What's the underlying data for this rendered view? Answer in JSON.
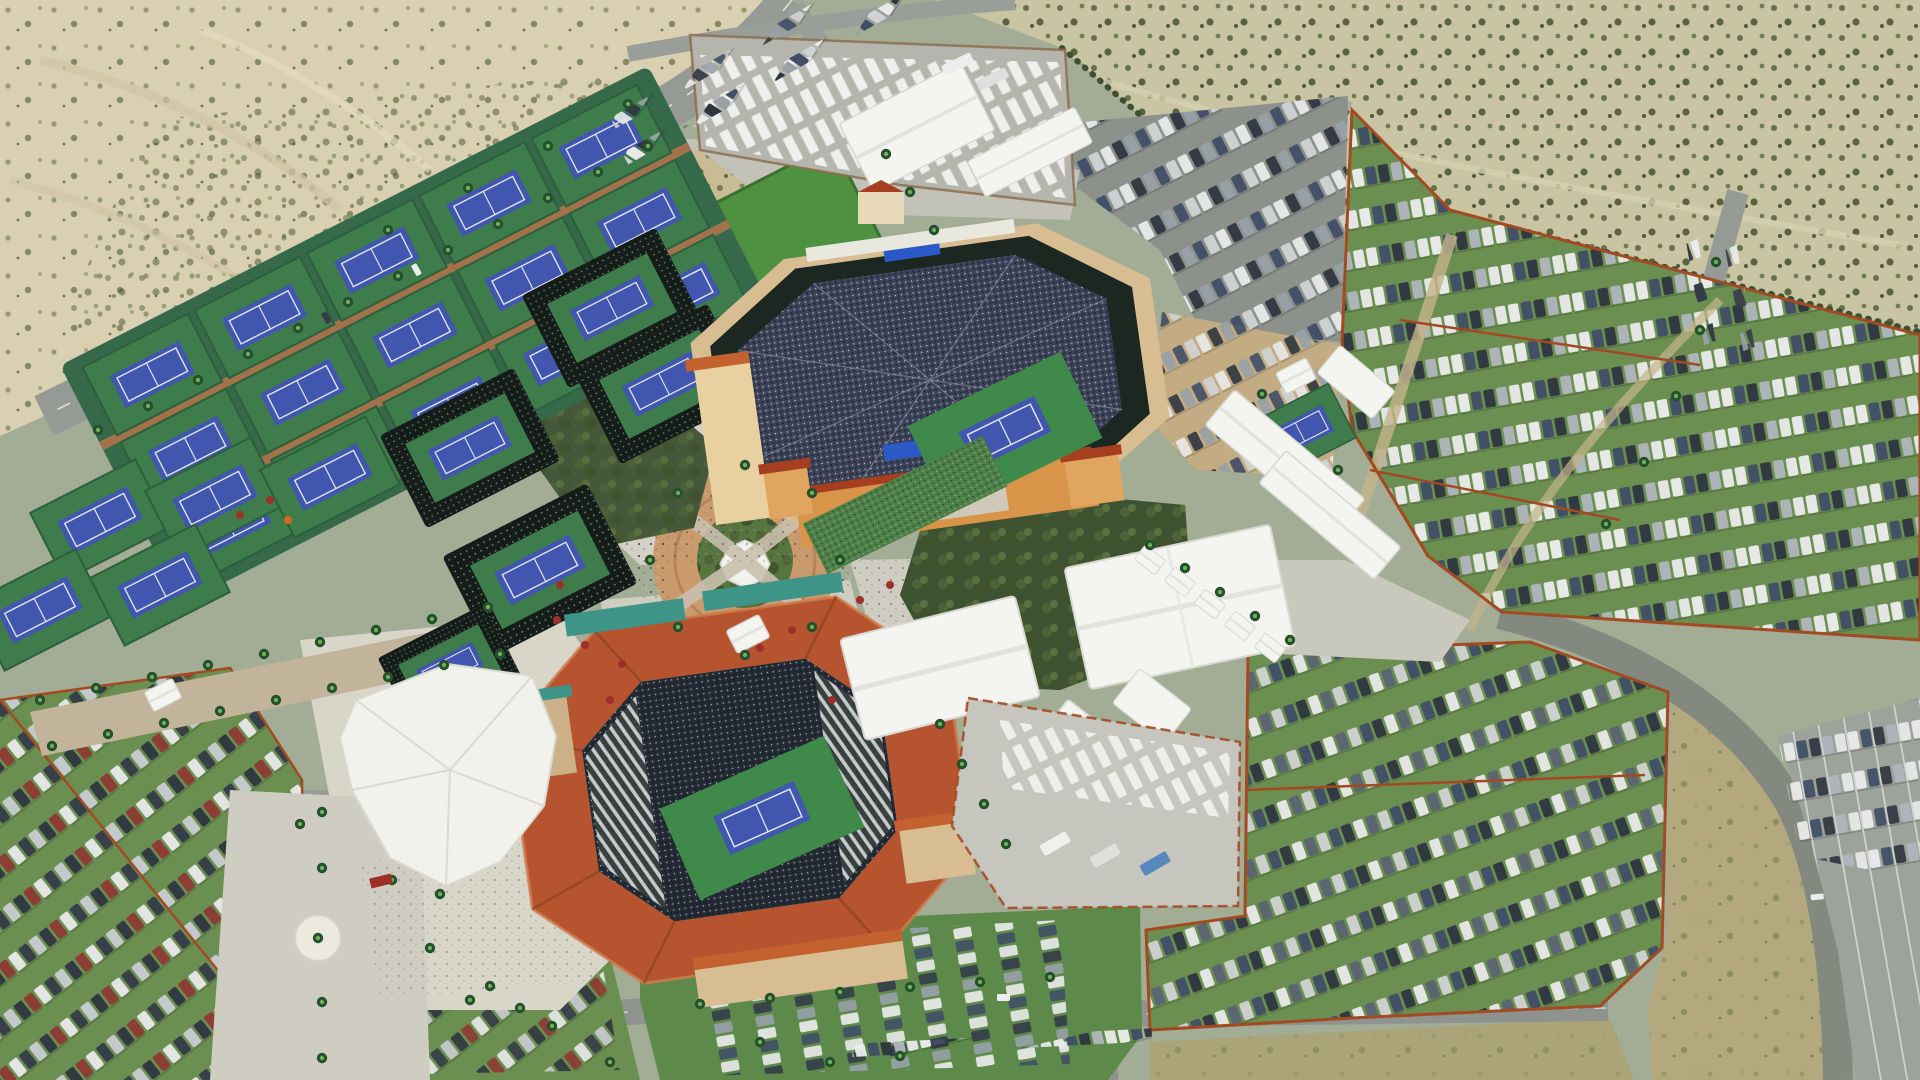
{
  "image": {
    "kind": "aerial-photograph",
    "subject": "large outdoor tennis tournament venue in a desert valley, oblique aerial view",
    "visible_text": "none",
    "width": 1920,
    "height": 1080
  },
  "scene": {
    "landmarks": [
      {
        "name": "desert-northwest",
        "desc": "bare sand with sparse scrub, upper left"
      },
      {
        "name": "desert-northeast",
        "desc": "scrub-covered desert field, upper right"
      },
      {
        "name": "perimeter-boulevard",
        "desc": "diagonal divided road with palms and curbside parked cars, upper left"
      },
      {
        "name": "practice-court-grid",
        "desc": "rows of blue tennis courts on green pads, northwest quadrant"
      },
      {
        "name": "sunken-show-courts",
        "desc": "five small match courts with dark bleachers and crowds"
      },
      {
        "name": "stadium-1",
        "desc": "large octagonal stadium, tan/orange buildings, packed crowd, blue court"
      },
      {
        "name": "stadium-2",
        "desc": "stadium with red tile roof ring, teal pavilion roofs, blue court, lower left-center"
      },
      {
        "name": "shade-sails",
        "desc": "white fabric shade structure at stadium 2 west entry"
      },
      {
        "name": "central-plaza",
        "desc": "circular brick plaza with gazebo, palms and crowds"
      },
      {
        "name": "tree-groves",
        "desc": "dense green tree groves beside stadiums"
      },
      {
        "name": "broadcast-compound",
        "desc": "TV trailers and long white tents, top center"
      },
      {
        "name": "hospitality-tents",
        "desc": "large white gabled tents southeast of stadium 1"
      },
      {
        "name": "service-yard",
        "desc": "concrete yard with trucks and trailers, bottom center-right"
      },
      {
        "name": "grass-parking",
        "desc": "turf parking fields full of car rows, east and southwest"
      },
      {
        "name": "paved-parking",
        "desc": "asphalt lots north of stadium 1 and bottom right corner"
      },
      {
        "name": "palm-entry-drives",
        "desc": "palm-lined entrance drives with white logo circle"
      }
    ],
    "counts": {
      "stadiums": 2,
      "sunken-show-courts": 5,
      "practice-courts": 21,
      "large-tents": 10,
      "tv-trailer-rows": 5
    }
  },
  "palette": {
    "base": "#a3ad95",
    "sandNW": "#d9d0b2",
    "sandNE": "#c9c5a3",
    "dryField": "#b3a87e",
    "dryBottom": "#aaa478",
    "road": "#969a94",
    "roadDark": "#84897f",
    "laneLine": "#e8e8e2",
    "asphaltLot": "#8d918c",
    "dirtLot": "#c3ac83",
    "grassLot": "#6b8f51",
    "lawn": "#4e9141",
    "fieldGreen": "#3f8a4b",
    "courtGreen": "#3e7c4c",
    "courtBlue": "#4156ae",
    "courtLine": "#dfe5ef",
    "plaza": "#d3d1c5",
    "concrete": "#c6c6bc",
    "brick": "#b5754a",
    "brickLight": "#c99a6b",
    "stands": "#1c2722",
    "crowd": "#3c4257",
    "tanBldg": "#d8bd92",
    "tanWall": "#e8d0a0",
    "orangeBldg": "#d8954a",
    "roofOrange": "#c3622f",
    "roofRed": "#b5542e",
    "roofRedDark": "#a63f1f",
    "teal": "#3f9488",
    "tentWhite": "#f4f5f1",
    "tentShadow": "#d8d8d0",
    "fenceRed": "#a34a22",
    "hedge": "#3f4f33",
    "tree": "#45593a",
    "treeDark": "#3d5230",
    "palmDark": "#24512c",
    "palmLight": "#74b05c",
    "videoBlue": "#2b59c8",
    "umbrellaRed": "#9c2f28",
    "white": "#f0efe8"
  }
}
